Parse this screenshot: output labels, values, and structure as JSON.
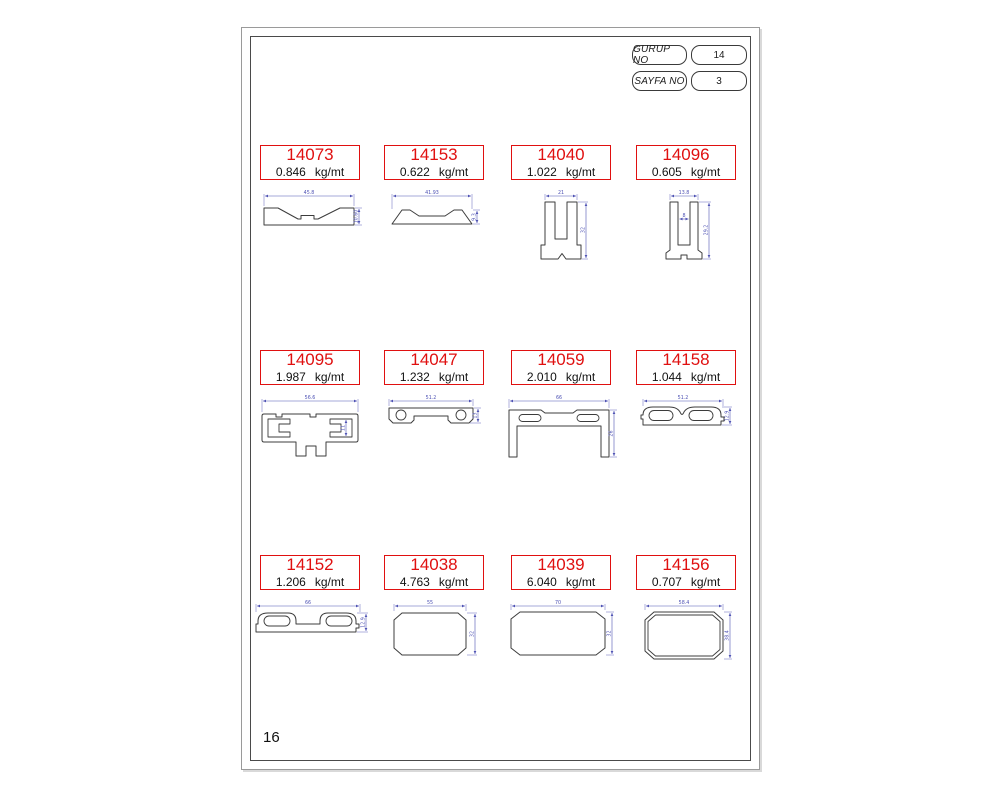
{
  "header": {
    "group_label": "GURUP NO",
    "group_value": "14",
    "page_label": "SAYFA NO",
    "page_value": "3"
  },
  "footer": {
    "page_number": "16"
  },
  "units": "kg/mt",
  "colors": {
    "accent_red": "#e01010",
    "dimension_blue": "#4e52b4",
    "outline_dark": "#3c3c3c"
  },
  "profiles": [
    {
      "code": "14073",
      "weight": "0.846",
      "dims": {
        "w": "45.8",
        "h": "10.60"
      }
    },
    {
      "code": "14153",
      "weight": "0.622",
      "dims": {
        "w": "41.93",
        "h": "9.3"
      }
    },
    {
      "code": "14040",
      "weight": "1.022",
      "dims": {
        "w": "21",
        "h": "32"
      }
    },
    {
      "code": "14096",
      "weight": "0.605",
      "dims": {
        "w": "13.8",
        "inner": "8",
        "h": "29.2"
      }
    },
    {
      "code": "14095",
      "weight": "1.987",
      "dims": {
        "w": "56.6",
        "inner": "11"
      }
    },
    {
      "code": "14047",
      "weight": "1.232",
      "dims": {
        "w": "51.2",
        "h": "13"
      }
    },
    {
      "code": "14059",
      "weight": "2.010",
      "dims": {
        "w": "66",
        "h": "26"
      }
    },
    {
      "code": "14158",
      "weight": "1.044",
      "dims": {
        "w": "51.2",
        "h": "12.9"
      }
    },
    {
      "code": "14152",
      "weight": "1.206",
      "dims": {
        "w": "66",
        "h": "12.9"
      }
    },
    {
      "code": "14038",
      "weight": "4.763",
      "dims": {
        "w": "55",
        "h": "32"
      }
    },
    {
      "code": "14039",
      "weight": "6.040",
      "dims": {
        "w": "70",
        "h": "32"
      }
    },
    {
      "code": "14156",
      "weight": "0.707",
      "dims": {
        "w": "58.4",
        "h": "38.4"
      }
    }
  ]
}
